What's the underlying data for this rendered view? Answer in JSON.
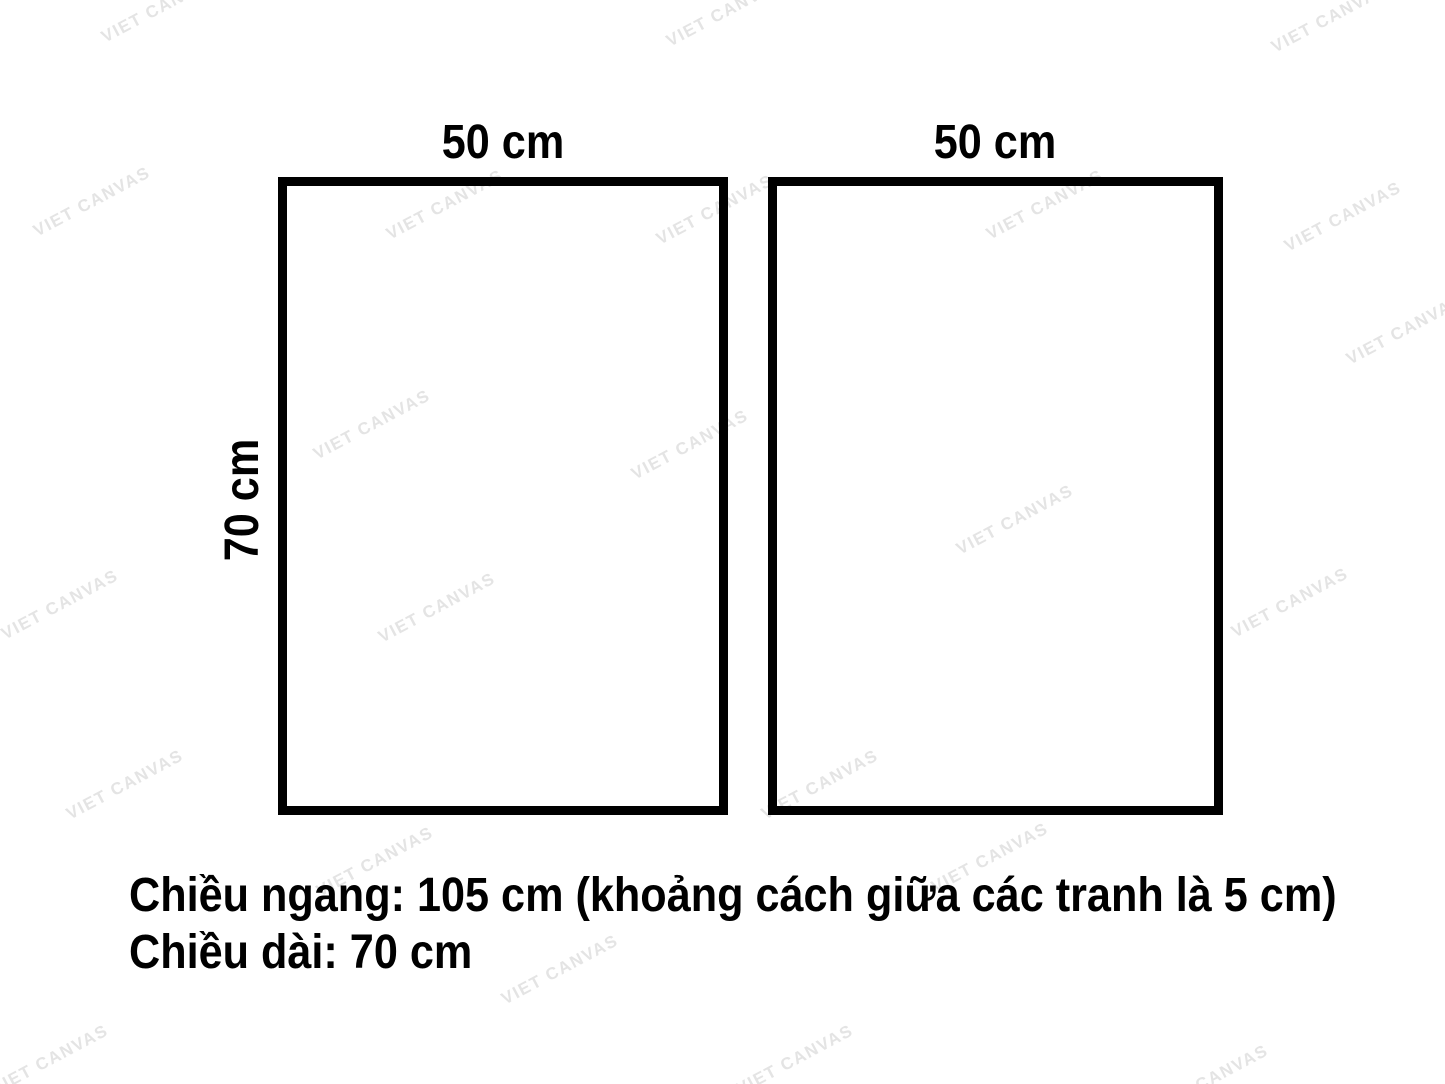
{
  "diagram": {
    "frames": [
      {
        "width_label": "50 cm"
      },
      {
        "width_label": "50 cm"
      }
    ],
    "height_label": "70 cm",
    "caption": {
      "line1": "Chiều ngang: 105 cm (khoảng cách giữa các tranh là 5 cm)",
      "line2": "Chiều dài: 70 cm"
    }
  },
  "watermark": {
    "text": "VIET CANVAS",
    "color": "#e4e4e4",
    "angle_deg": -28,
    "positions": [
      [
        160,
        8
      ],
      [
        725,
        12
      ],
      [
        1330,
        18
      ],
      [
        92,
        202
      ],
      [
        445,
        205
      ],
      [
        715,
        210
      ],
      [
        1045,
        205
      ],
      [
        1343,
        217
      ],
      [
        1405,
        330
      ],
      [
        372,
        425
      ],
      [
        690,
        445
      ],
      [
        1015,
        520
      ],
      [
        60,
        605
      ],
      [
        437,
        608
      ],
      [
        1290,
        603
      ],
      [
        125,
        785
      ],
      [
        820,
        785
      ],
      [
        375,
        862
      ],
      [
        990,
        858
      ],
      [
        560,
        970
      ],
      [
        50,
        1060
      ],
      [
        795,
        1060
      ],
      [
        1210,
        1080
      ]
    ]
  },
  "colors": {
    "background": "#ffffff",
    "frame_border": "#000000",
    "text": "#000000"
  }
}
